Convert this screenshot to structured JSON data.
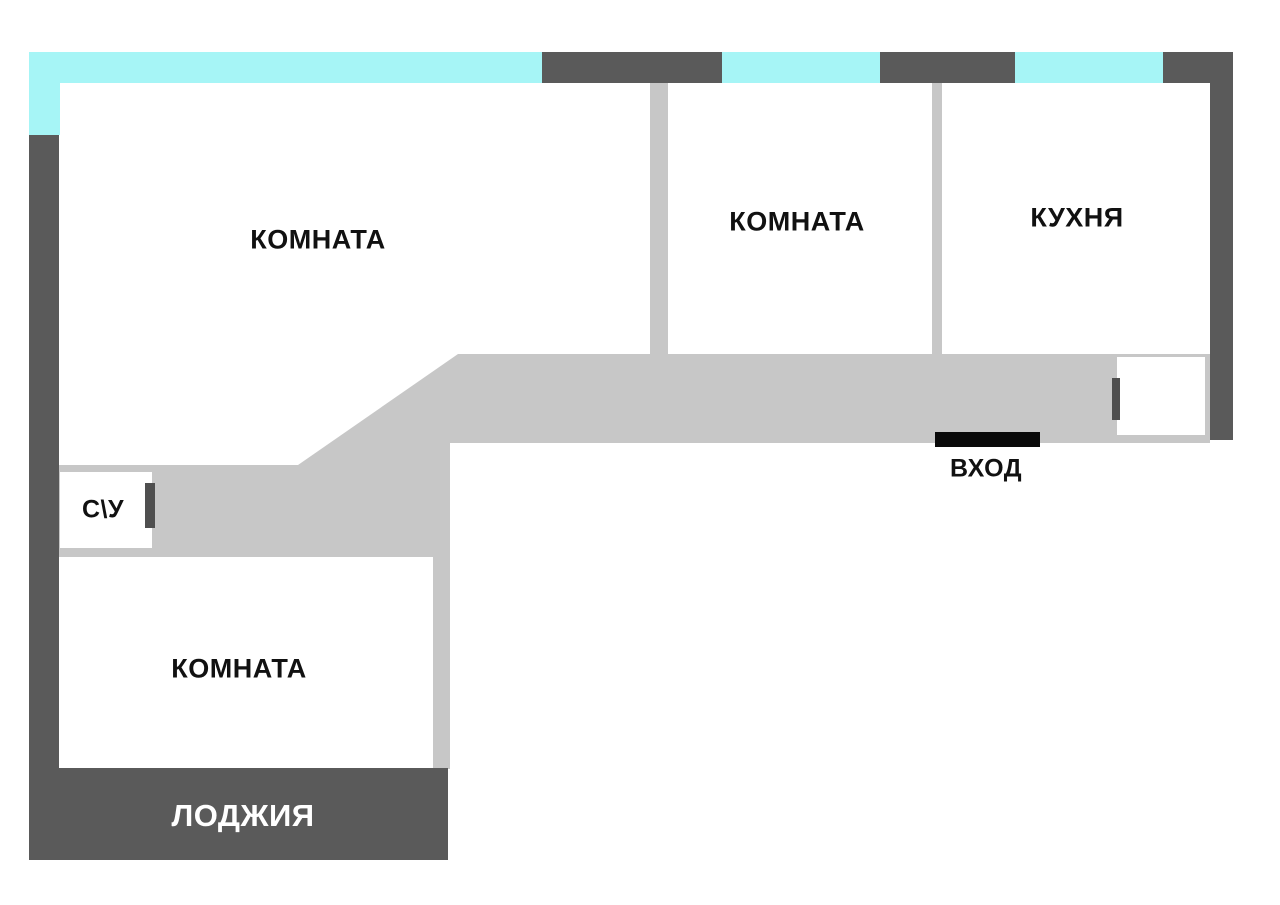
{
  "page": {
    "title": "План квартиры (поэтажный план)"
  },
  "colors": {
    "wall_dark": "#5a5a5a",
    "corridor_gray": "#c7c7c7",
    "window_cyan": "#a6f5f6",
    "door_marker": "#4f4f4f",
    "entrance_black": "#0a0a0a",
    "room_white": "#ffffff",
    "label_black": "#111111",
    "loggia_label_white": "#ffffff"
  },
  "labels": {
    "room_left": "КОМНАТА",
    "room_middle": "КОМНАТА",
    "kitchen": "КУХНЯ",
    "bathroom": "С\\У",
    "room_bottom": "КОМНАТА",
    "entrance": "ВХОД",
    "loggia": "ЛОДЖИЯ"
  }
}
